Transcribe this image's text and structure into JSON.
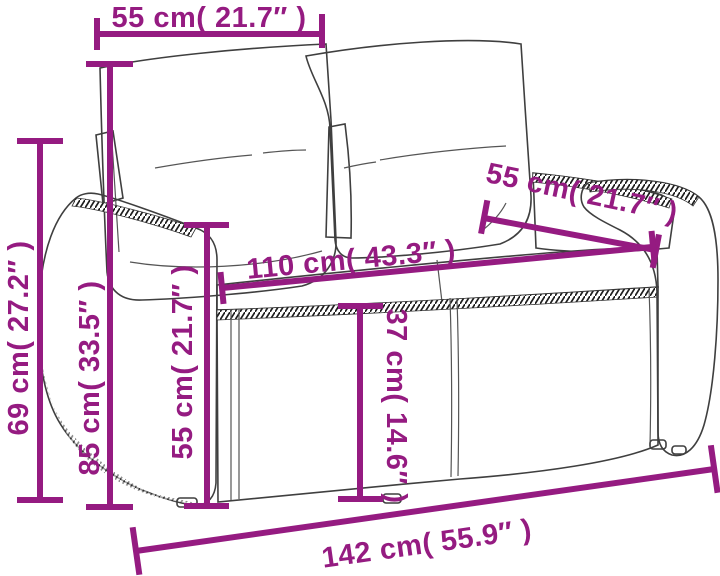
{
  "diagram": {
    "title": "Rattan loveseat sofa dimension diagram",
    "illustration": "wicker-2-seater-sofa-line-drawing",
    "accent_color": "#951b81",
    "line_art_color": "#3f3f3f"
  },
  "dimensions": {
    "top_backrest_width": {
      "label": "55 cm( 21.7″ )",
      "cm": "55",
      "inches": "21.7"
    },
    "right_backrest_width": {
      "label": "55 cm( 21.7″ )",
      "cm": "55",
      "inches": "21.7"
    },
    "seat_width": {
      "label": "110 cm( 43.3″ )",
      "cm": "110",
      "inches": "43.3"
    },
    "back_height": {
      "label": "69 cm( 27.2″ )",
      "cm": "69",
      "inches": "27.2"
    },
    "armrest_height": {
      "label": "85 cm( 33.5″ )",
      "cm": "85",
      "inches": "33.5"
    },
    "inner_back_height": {
      "label": "55 cm( 21.7″ )",
      "cm": "55",
      "inches": "21.7"
    },
    "seat_height": {
      "label": "37 cm( 14.6″ )",
      "cm": "37",
      "inches": "14.6"
    },
    "total_width": {
      "label": "142 cm( 55.9″ )",
      "cm": "142",
      "inches": "55.9"
    }
  }
}
